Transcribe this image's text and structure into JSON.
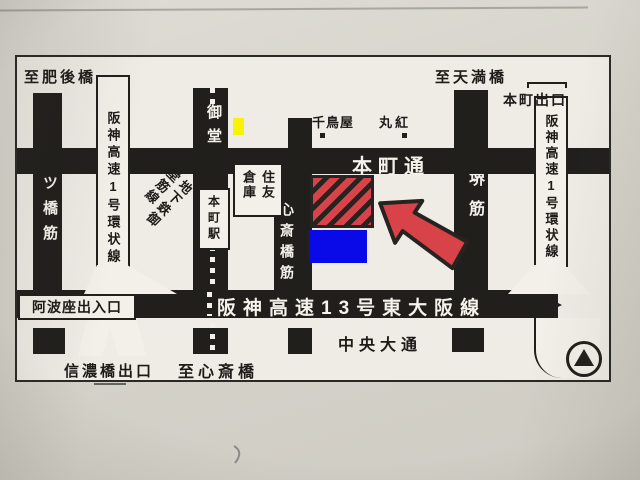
{
  "colors": {
    "road_black": "#201f1c",
    "highlight_red": "#d8434a",
    "annotation_blue": "#0a0ae8",
    "annotation_yellow": "#f8f400",
    "paper": "#d7d4cc",
    "map_background": "#eeece4"
  },
  "map": {
    "edge_labels": {
      "to_higobashi": "至肥後橋",
      "to_temmabashi": "至天満橋",
      "to_shinsaibashi": "至心斎橋"
    },
    "exits": {
      "honmachi_exit": "本町出口",
      "awaza_ramp": "阿波座出入口",
      "shinanobashi_exit": "信濃橋出口"
    },
    "roads": {
      "yotsubashisuji": "四ツ橋筋",
      "hanshin_loop_west": "阪神高速1号環状線",
      "midosuji": "御堂筋",
      "shinsaibashisuji": "心斎橋筋",
      "sakaisuji": "堺筋",
      "hanshin_loop_east": "阪神高速1号環状線",
      "honmachidori": "本町通",
      "hanshin_13_higashiosaka": "阪神高速13号東大阪線",
      "chuo_odori": "中央大通"
    },
    "subway": {
      "midosuji_line": "地下鉄御堂筋線",
      "honmachi_station": "本町駅"
    },
    "landmarks": {
      "chidoriya": "千鳥屋",
      "marubeni": "丸紅",
      "sumitomo_warehouse": "住友倉庫"
    }
  }
}
